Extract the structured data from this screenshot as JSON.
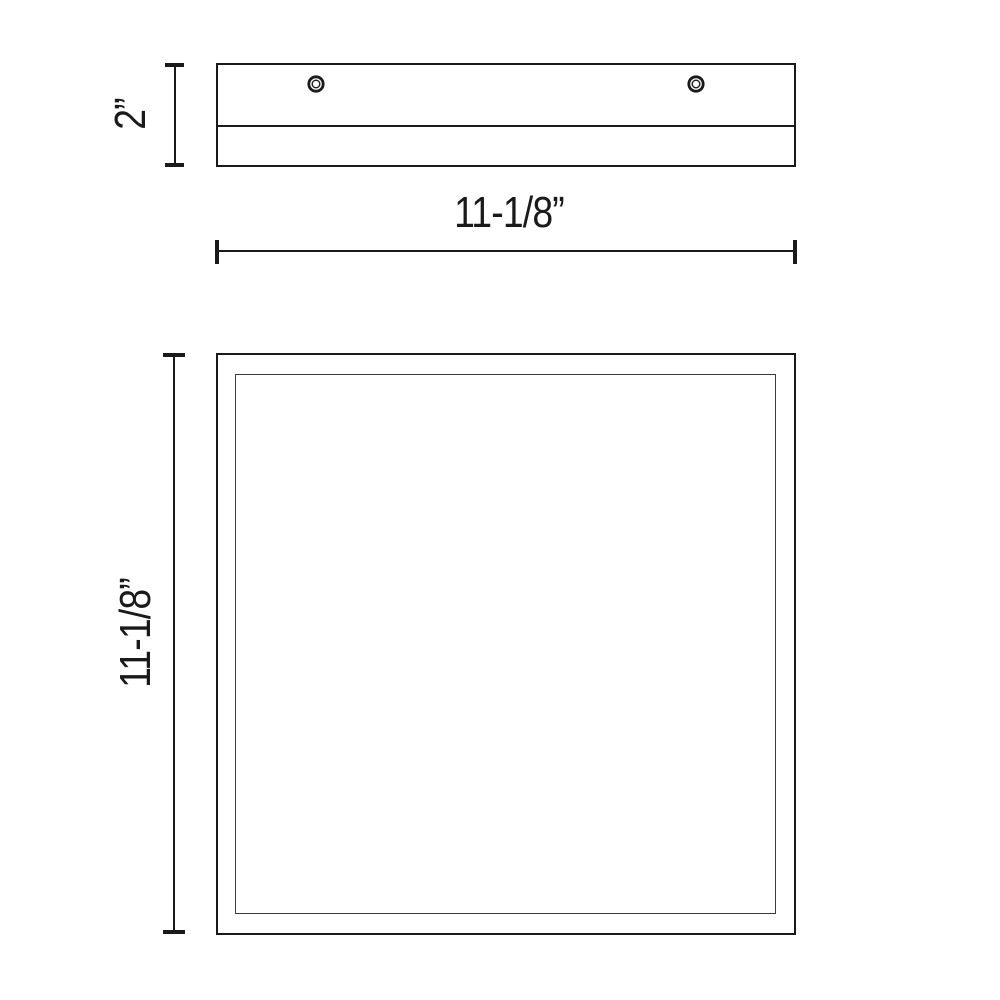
{
  "drawing": {
    "type": "product dimension drawing",
    "colors": {
      "line": "#1a1a1a",
      "background": "#ffffff"
    },
    "side_view": {
      "height_label": "2”",
      "screw_icons": [
        "mounting-screw-left",
        "mounting-screw-right"
      ]
    },
    "width_dimension": {
      "label": "11-1/8”"
    },
    "front_view": {
      "height_label": "11-1/8”"
    }
  }
}
